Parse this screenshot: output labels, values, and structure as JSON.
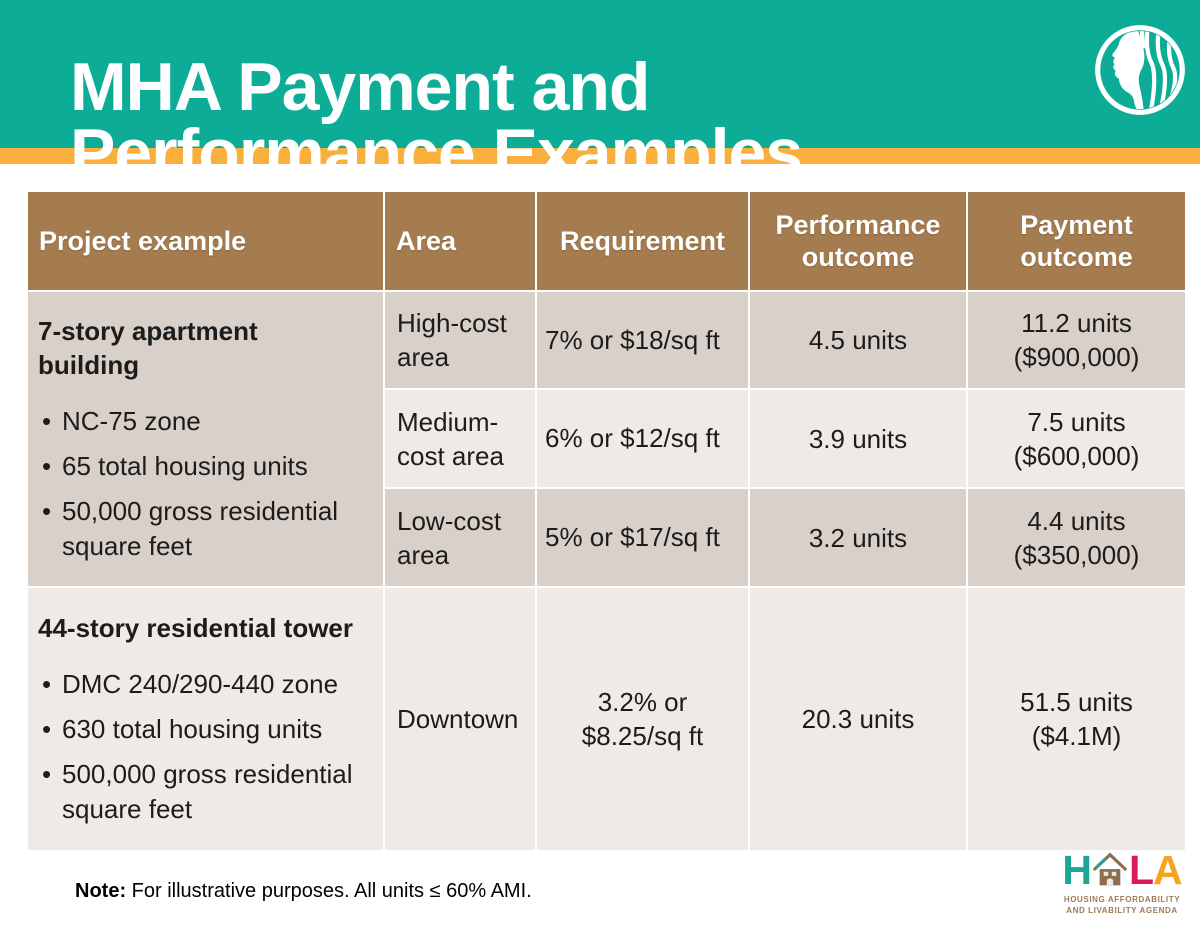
{
  "slide": {
    "title": "MHA Payment and Performance Examples"
  },
  "icons": {
    "city_logo": "seattle-city-logo",
    "hala_house": "hala-house-icon"
  },
  "colors": {
    "teal": "#0CAC97",
    "orange": "#F9AF3C",
    "header_brown": "#A57C50",
    "row_dark": "#D8D0C9",
    "row_light": "#EFEAE6"
  },
  "table": {
    "columns": [
      "Project example",
      "Area",
      "Requirement",
      "Performance outcome",
      "Payment outcome"
    ],
    "groups": [
      {
        "title": "7-story apartment building",
        "bullets": [
          "NC-75 zone",
          "65 total housing units",
          "50,000 gross residential square feet"
        ],
        "rows": [
          {
            "area": "High-cost area",
            "requirement": "7% or $18/sq ft",
            "performance": "4.5 units",
            "payment": [
              "11.2 units",
              "($900,000)"
            ]
          },
          {
            "area": "Medium-cost area",
            "requirement": "6% or $12/sq ft",
            "performance": "3.9 units",
            "payment": [
              "7.5 units",
              "($600,000)"
            ]
          },
          {
            "area": "Low-cost area",
            "requirement": "5% or $17/sq ft",
            "performance": "3.2 units",
            "payment": [
              "4.4 units",
              "($350,000)"
            ]
          }
        ]
      },
      {
        "title": "44-story residential tower",
        "bullets": [
          "DMC 240/290-440 zone",
          "630 total housing units",
          "500,000 gross residential square feet"
        ],
        "rows": [
          {
            "area": "Downtown",
            "requirement": [
              "3.2% or",
              "$8.25/sq ft"
            ],
            "performance": "20.3 units",
            "payment": [
              "51.5 units",
              "($4.1M)"
            ]
          }
        ]
      }
    ]
  },
  "footer": {
    "note_label": "Note:",
    "note_text": "For illustrative purposes. All units ≤ 60% AMI.",
    "hala": {
      "letter_h": "H",
      "letter_l": "L",
      "letter_a": "A",
      "tagline_line1": "HOUSING AFFORDABILITY",
      "tagline_line2": "AND LIVABILITY AGENDA",
      "colors": {
        "h": "#1CA695",
        "l": "#DB1A5C",
        "a": "#F6A41F",
        "house": "#8B6F4E",
        "tagline": "#9B7C55"
      }
    }
  }
}
